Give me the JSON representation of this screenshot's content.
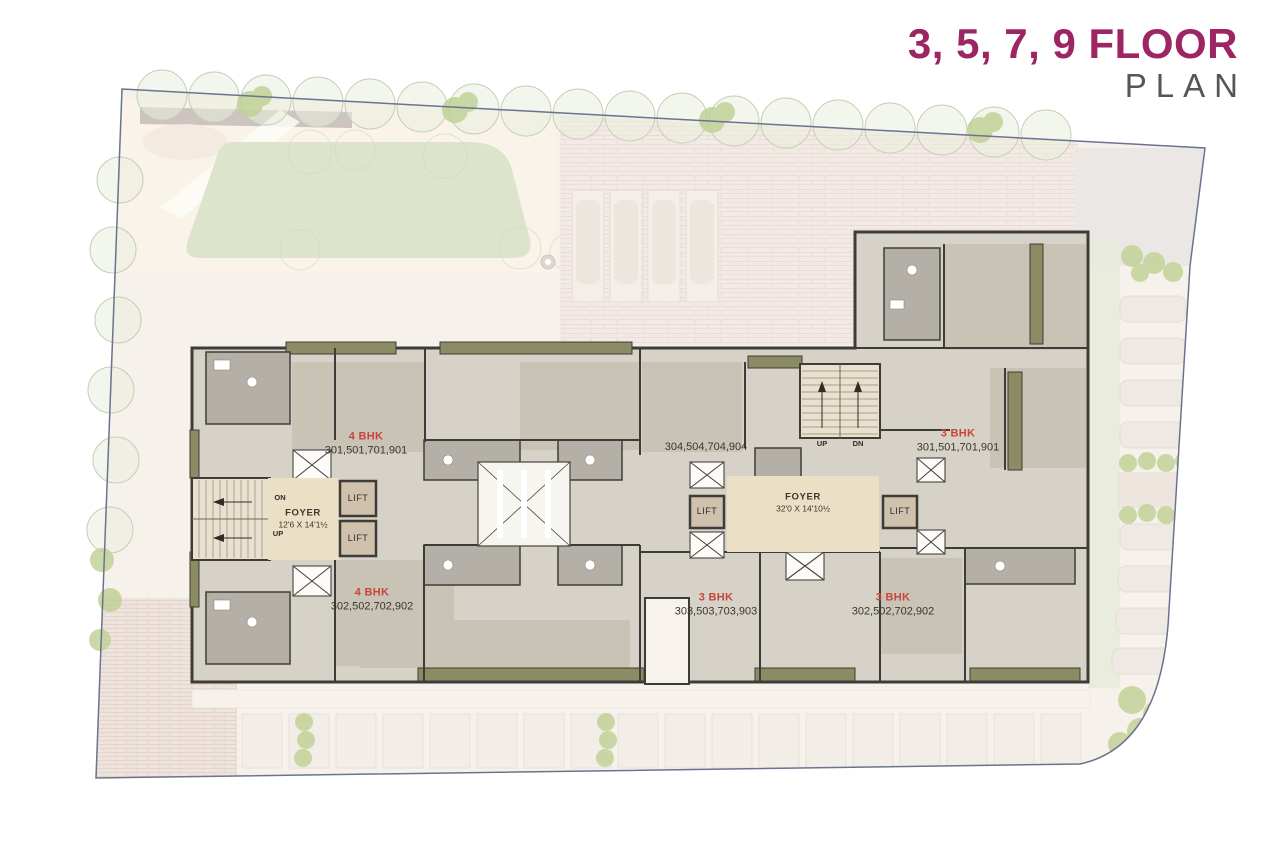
{
  "title": {
    "floors": "3, 5, 7, 9 FLOOR",
    "word": "PLAN"
  },
  "units": [
    {
      "type": "4 BHK",
      "numbers": "301,501,701,901"
    },
    {
      "type": "",
      "numbers": "304,504,704,904"
    },
    {
      "type": "3 BHK",
      "numbers": "301,501,701,901"
    },
    {
      "type": "4 BHK",
      "numbers": "302,502,702,902"
    },
    {
      "type": "3 BHK",
      "numbers": "303,503,703,903"
    },
    {
      "type": "3 BHK",
      "numbers": "302,502,702,902"
    }
  ],
  "foyers": [
    {
      "label": "FOYER",
      "dims": "12'6  X 14'1½"
    },
    {
      "label": "FOYER",
      "dims": "32'0 X 14'10½"
    }
  ],
  "lift_label": "LIFT",
  "stairs": {
    "left_top": "ON",
    "left_bottom": "UP",
    "center_left": "UP",
    "center_right": "DN"
  },
  "colors": {
    "accent": "#9e2564",
    "plan_gray": "#54565a",
    "unit_red": "#c8453c",
    "wall": "#3e3c38",
    "room": "#d6d2c7",
    "olive": "#8b8c63",
    "foyer_tan": "#ebdfc5"
  }
}
